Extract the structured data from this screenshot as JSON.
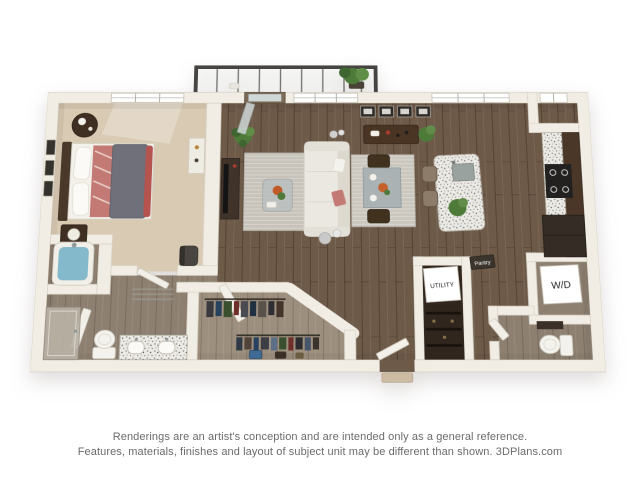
{
  "page": {
    "background": "#ffffff",
    "width": 640,
    "height": 480
  },
  "floorplan": {
    "type": "3d-floor-plan-rendering",
    "labels": {
      "utility": "UTILITY",
      "washer_dryer": "W/D",
      "pantry": "Pantry"
    },
    "colors": {
      "wall": "#f1ede4",
      "wallEdge": "#d8d2c5",
      "woodFloor": "#6e5a49",
      "bathFloor": "#8d8071",
      "closetFloor": "#9d8f7e",
      "carpet": "#d9cab3",
      "tubWater": "#84b9cc",
      "counter": "#eceae4",
      "cabinet": "#4a3728",
      "appliance": "#22211f",
      "rugLiving": "#c7c3ba",
      "rugDining": "#cbc7bf",
      "sofa": "#eae8e1",
      "duvet": "#70707a",
      "coral": "#c47a74",
      "accentRed": "#b5534f",
      "plant": "#4e7a3a",
      "railing": "#454441",
      "signBg": "#ffffff",
      "signText": "#1d1d1d",
      "doorFrame": "#7b6a56",
      "stepStone": "#cdbba4"
    },
    "closet": {
      "rack1": [
        "#3a3a3e",
        "#27415e",
        "#394f2e",
        "#6e2f2a",
        "#4a4a52",
        "#203040",
        "#57524a",
        "#2e2e34",
        "#44352a"
      ],
      "rack2": [
        "#2f3a46",
        "#50433a",
        "#27415e",
        "#3d3d45",
        "#5d6f86",
        "#394f2e",
        "#6e2f2a",
        "#2c2c30",
        "#46566a",
        "#3a332c"
      ]
    }
  },
  "disclaimer": {
    "line1": "Renderings are an artist's conception and are intended only as a general reference.",
    "line2": "Features, materials, finishes and layout of subject unit may be different than shown. 3DPlans.com"
  }
}
